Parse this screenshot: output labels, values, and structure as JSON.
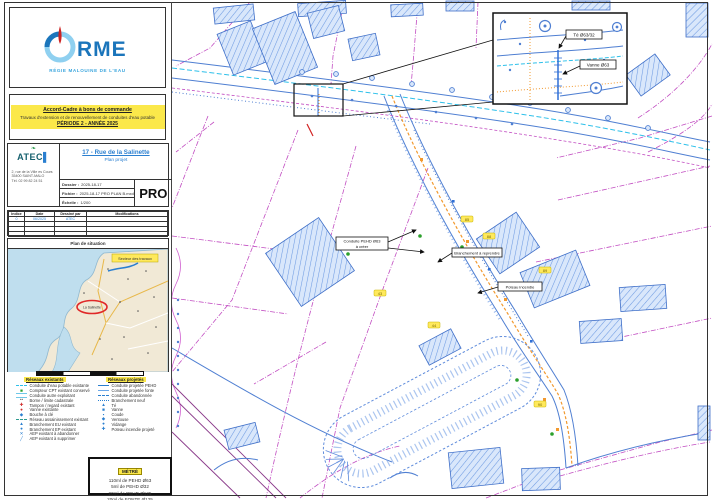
{
  "colors": {
    "brand_blue": "#1b75bb",
    "brand_lightblue": "#3aa5dd",
    "logo_red": "#cc2222",
    "highlight_yellow": "#fbe84a",
    "plan_blue": "#4f7fd2",
    "building_fill": "#d9e7fb",
    "existing_pipe_cyan": "#2ec0ea",
    "project_pipe_orange": "#f2992e",
    "parcel_magenta": "#c24ec2",
    "green_marker": "#2ca02c",
    "chip_yellow": "#ffe95c",
    "map_sea": "#bfdeee",
    "map_land": "#f1e9d6",
    "marker_red": "#e02828"
  },
  "left_panel": {
    "logo": {
      "brand": "RME",
      "tagline": "RÉGIE MALOUINE DE L'EAU"
    },
    "notice": {
      "line1": "Accord-Cadre à bons de commande",
      "line2": "Travaux d'extension et de renouvellement de conduites d'eau potable",
      "line3": "PÉRIODE 2 - ANNÉE 2025"
    },
    "title_block": {
      "company": "ATEC",
      "address_lines": [
        "2, rue de la Ville es Cours",
        "35400 SAINT-MALO",
        "Tél. 02 99 82 24 51"
      ],
      "title": "17 - Rue de la Salinette",
      "subtitle": "Plan projet",
      "rows": [
        {
          "label": "Dossier :",
          "value": "2025-18-17"
        },
        {
          "label": "Fichier :",
          "value": "2025-18-17 PRO PLAN B.mxd"
        },
        {
          "label": "Échelle :",
          "value": "1/200"
        }
      ],
      "stamp": "PRO"
    },
    "revision_table": {
      "headers": [
        "Indice",
        "Date",
        "Dessiné par",
        "Modifications"
      ],
      "rows": [
        [
          "0",
          "06/2025",
          "ATEC",
          ""
        ],
        [
          "",
          "",
          "",
          ""
        ],
        [
          "",
          "",
          "",
          ""
        ],
        [
          "",
          "",
          "",
          ""
        ]
      ]
    },
    "situation": {
      "title": "Plan de situation",
      "highlight_label": "La Salinette",
      "callout_label": "Secteur des travaux"
    },
    "legend": {
      "left": {
        "header": "Réseaux existants",
        "items": [
          {
            "style": "dashed",
            "color": "#2ec0ea",
            "label": "Conduite d'eau potable existante"
          },
          {
            "glyph": "■",
            "color": "#2ca02c",
            "label": "Compteur CPT existant conservé"
          },
          {
            "style": "double",
            "color": "#6fc8e8",
            "label": "Conduite autre exploitant"
          },
          {
            "glyph": "••",
            "color": "#777777",
            "label": "Borne / limite cadastrale"
          },
          {
            "glyph": "✚",
            "color": "#d03030",
            "label": "Tampon / regard existant"
          },
          {
            "glyph": "●",
            "color": "#d03030",
            "label": "Vanne existante"
          },
          {
            "glyph": "◆",
            "color": "#2a7fd0",
            "label": "Bouche à clé"
          },
          {
            "style": "dashed",
            "color": "#2d9b8f",
            "label": "Réseau assainissement existant"
          },
          {
            "glyph": "▲",
            "color": "#2a7fd0",
            "label": "Branchement EU existant"
          },
          {
            "glyph": "●",
            "color": "#2a7fd0",
            "label": "Branchement EP existant"
          },
          {
            "glyph": "✕",
            "color": "#2a7fd0",
            "label": "AEP existant à abandonner"
          },
          {
            "glyph": "╱",
            "color": "#2a7fd0",
            "label": "AEP existant à supprimer"
          }
        ]
      },
      "right": {
        "header": "Réseaux projetés",
        "items": [
          {
            "style": "solid",
            "color": "#2a7fd0",
            "label": "Conduite projetée PEHD"
          },
          {
            "style": "solid",
            "color": "#6aa7e8",
            "label": "Conduite projetée fonte"
          },
          {
            "style": "dashed",
            "color": "#2a7fd0",
            "label": "Conduite abandonnée"
          },
          {
            "style": "dotted",
            "color": "#2a7fd0",
            "label": "Branchement neuf"
          },
          {
            "glyph": "▲",
            "color": "#2a7fd0",
            "label": "Té"
          },
          {
            "glyph": "■",
            "color": "#2a7fd0",
            "label": "Vanne"
          },
          {
            "glyph": "▪",
            "color": "#2a7fd0",
            "label": "Coude"
          },
          {
            "glyph": "◆",
            "color": "#2a7fd0",
            "label": "Ventouse"
          },
          {
            "glyph": "●",
            "color": "#2a7fd0",
            "label": "Vidange"
          },
          {
            "glyph": "✚",
            "color": "#2a7fd0",
            "label": "Poteau incendie projeté"
          }
        ]
      }
    },
    "cartouche": {
      "header": "MÉTRÉ",
      "lines": [
        "110ml de PEHD Ø63",
        "5ml de PEHD Ø32",
        "20ml de PEHD Ø125",
        "20ml de FONTE Ø125"
      ]
    }
  },
  "plan": {
    "inset_labels": [
      "Té Ø63/32",
      "Vanne Ø63"
    ],
    "callouts": [
      {
        "line1": "Conduite PEHD Ø63",
        "line2": "à créer"
      },
      {
        "line1": "Branchement à reprendre"
      },
      {
        "line1": "Poteau incendie"
      }
    ],
    "parcel_numbers": [
      "85",
      "88",
      "89",
      "44",
      "90",
      "43"
    ]
  }
}
